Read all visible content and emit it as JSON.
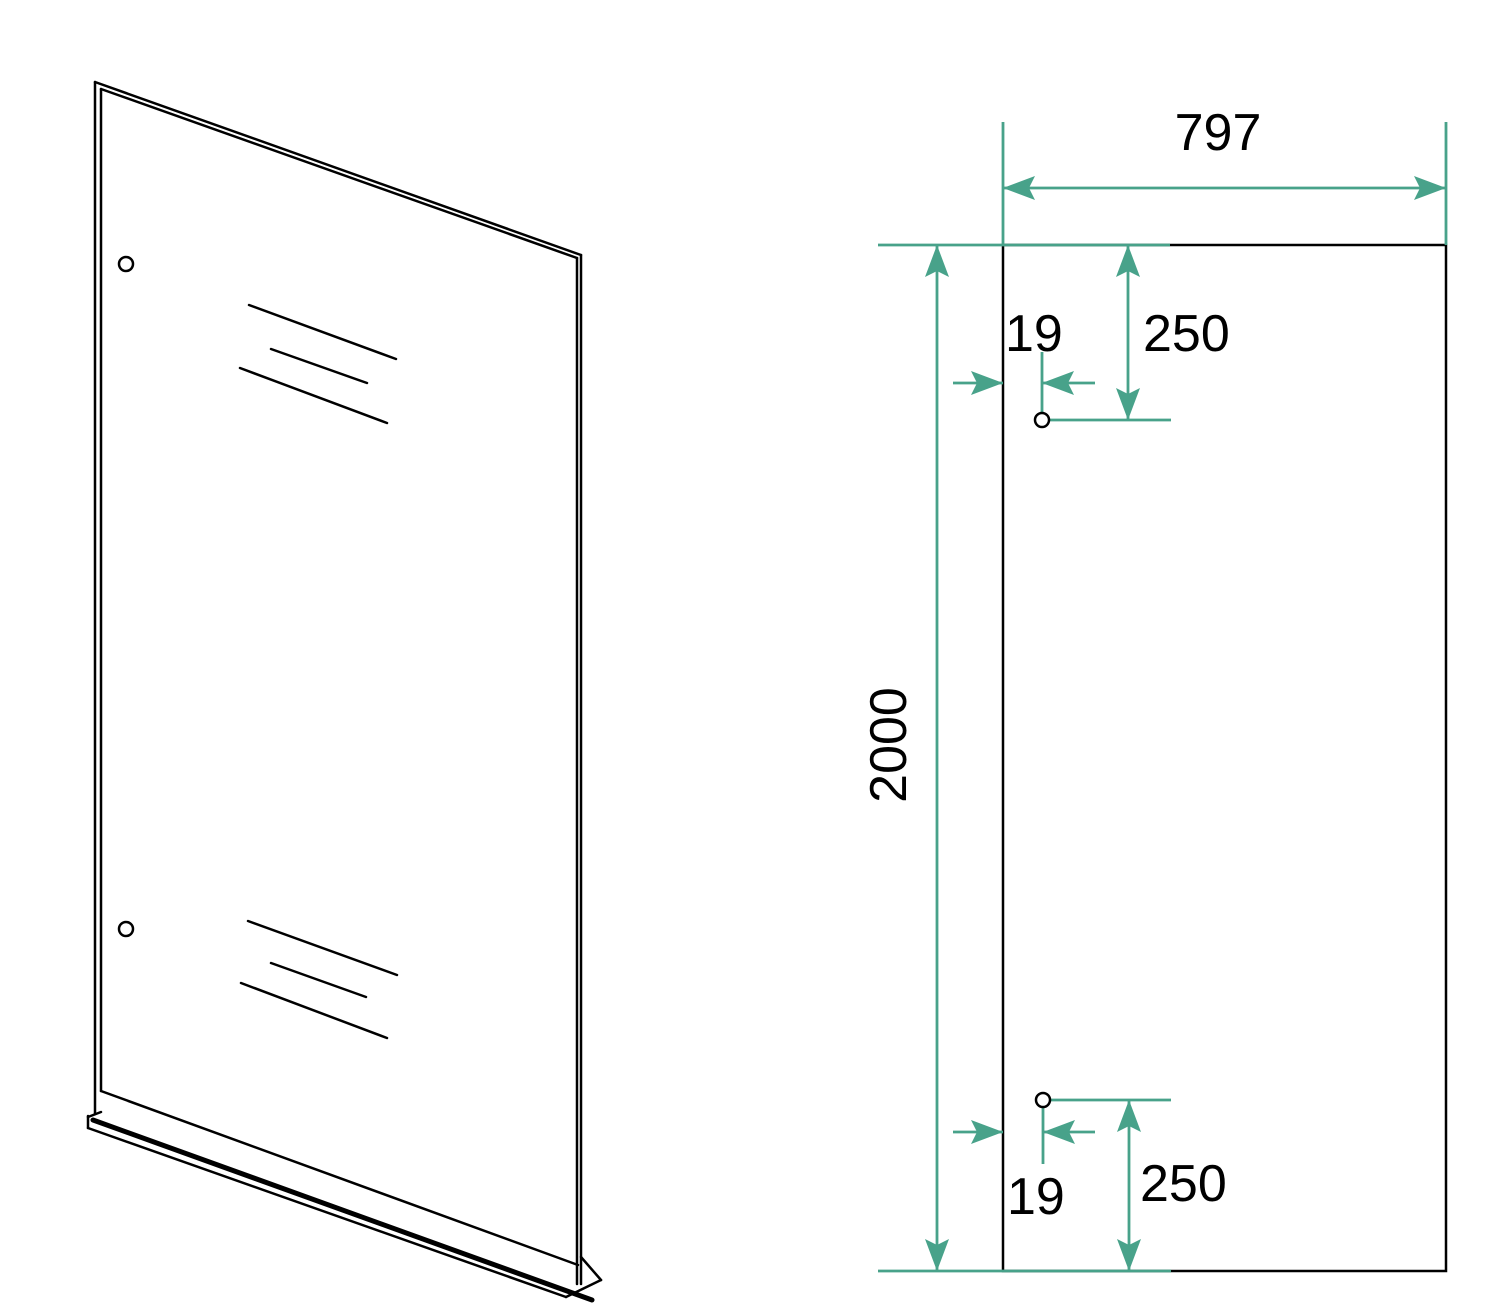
{
  "dims": {
    "width": "797",
    "height": "2000",
    "top_hole_offset_x": "19",
    "top_hole_offset_y": "250",
    "bottom_hole_offset_x": "19",
    "bottom_hole_offset_y": "250"
  },
  "colors": {
    "dimension_accent": "#48a28a",
    "line": "#000000",
    "background": "#ffffff"
  }
}
